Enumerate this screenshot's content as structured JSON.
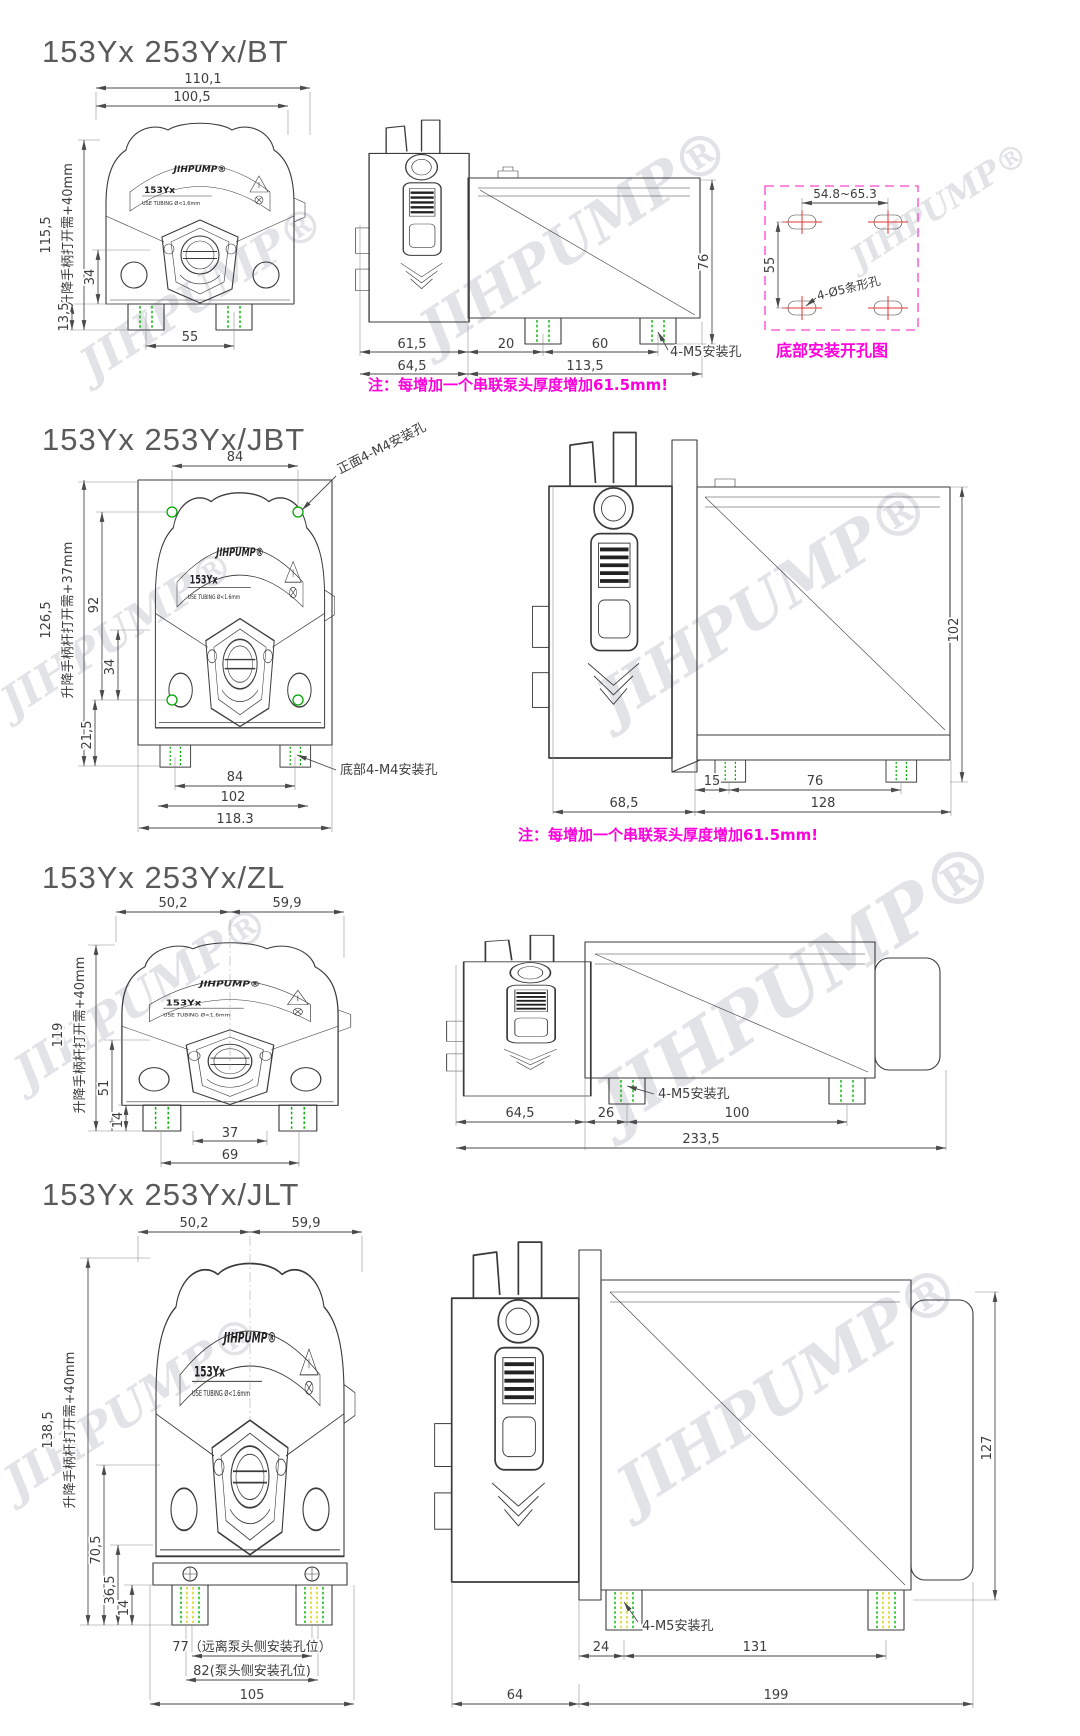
{
  "page": {
    "background": "#ffffff"
  },
  "brand": {
    "watermark": "JIHPUMP®",
    "plate_logo": "JIHPUMP®",
    "plate_model": "153Yx",
    "plate_tubing": "USE TUBING Ø<1.6mm"
  },
  "colors": {
    "note_magenta": "#ff00dd",
    "hole_box_pink": "#ff63d8",
    "mount_dash_green": "#00b400",
    "mount_dash_yellow": "#cfd400",
    "slot_cross_red": "#e23434",
    "drawing_line": "#3b3b3b",
    "dim_text": "#3d3d3d"
  },
  "sections": [
    {
      "id": "bt",
      "title": "153Yx 253Yx/BT",
      "front": {
        "width_outer": "110,1",
        "width_inner": "100,5",
        "height": "115,5",
        "height_note": "升降手柄打开需+40mm",
        "knob_to_base": "34",
        "base_to_foot": "13,5",
        "foot_span": "55"
      },
      "side": {
        "head_depth": "61,5",
        "head_to_foot": "20",
        "foot_span": "60",
        "mount_label": "4-M5安装孔",
        "depth_head": "64,5",
        "depth_body": "113,5",
        "height": "76"
      },
      "note": "注：每增加一个串联泵头厚度增加61.5mm!",
      "hole_diagram": {
        "slot_span": "54.8~65.3",
        "row_span": "55",
        "slot_label": "4-Ø5条形孔",
        "caption": "底部安装开孔图"
      }
    },
    {
      "id": "jbt",
      "title": "153Yx 253Yx/JBT",
      "front": {
        "hole_span_top": "84",
        "front_hole_label": "正面4-M4安装孔",
        "height": "126,5",
        "height_note": "升降手柄杆打开需+37mm",
        "hole_span_v": "92",
        "knob_to_hole": "34",
        "hole_to_foot": "21,5",
        "foot_span": "84",
        "plate_width": "102",
        "width": "118.3",
        "bottom_hole_label": "底部4-M4安装孔"
      },
      "side": {
        "plate_to_foot": "15",
        "foot_span": "76",
        "head_depth": "68,5",
        "body_depth": "128",
        "height": "102"
      },
      "note": "注：每增加一个串联泵头厚度增加61.5mm!"
    },
    {
      "id": "zl",
      "title": "153Yx 253Yx/ZL",
      "front": {
        "width_left": "50,2",
        "width_right": "59,9",
        "height": "119",
        "height_note": "升降手柄杆打开需+40mm",
        "knob_to_foot": "51",
        "foot_height": "14",
        "slot_span": "37",
        "foot_span": "69"
      },
      "side": {
        "mount_label": "4-M5安装孔",
        "head_depth": "64,5",
        "head_to_foot": "26",
        "foot_span": "100",
        "total_depth": "233,5"
      }
    },
    {
      "id": "jlt",
      "title": "153Yx 253Yx/JLT",
      "front": {
        "width_left": "50,2",
        "width_right": "59,9",
        "height": "138,5",
        "height_note": "升降手柄杆打开需+40mm",
        "knob_to_foot": "70,5",
        "base_height": "36,5",
        "foot_height": "14",
        "foot_span_far": "77（远离泵头侧安装孔位）",
        "foot_span_near": "82(泵头侧安装孔位)",
        "width": "105"
      },
      "side": {
        "mount_label": "4-M5安装孔",
        "plate_to_foot": "24",
        "foot_span": "131",
        "head_depth": "64",
        "body_depth": "199",
        "height": "127"
      }
    }
  ]
}
